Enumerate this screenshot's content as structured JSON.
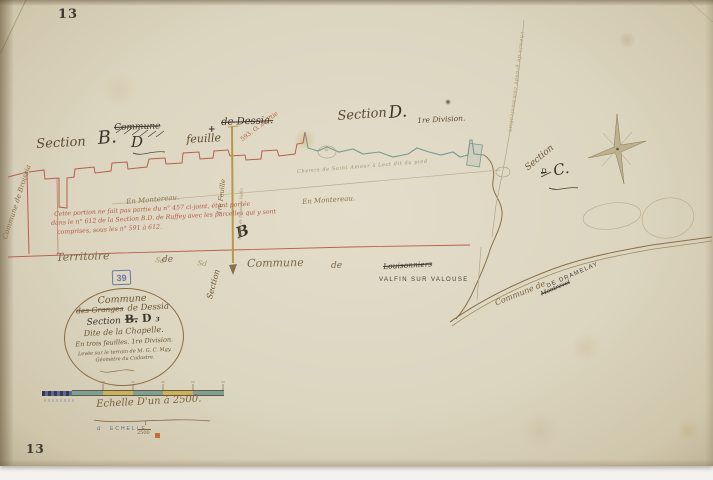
{
  "page": {
    "folio_top": "13",
    "folio_bottom": "13"
  },
  "colors": {
    "red_line": "#b5604e",
    "teal_line": "#7b9a92",
    "yellow_road": "#b9984a",
    "brown_ink": "#6b5535",
    "dark_ink": "#3c342a",
    "red_ink": "#ab5a48",
    "blue_stamp": "#5a68a0",
    "paper": "#dbd3bd"
  },
  "header": {
    "section_b": {
      "section": "Section",
      "letter": "B.",
      "d_word": "D",
      "feuille": "feuille",
      "struck_commune": "Commune",
      "cross": "+",
      "struck_dessia": "de Dessia.",
      "parcel_ref": "593. O. 2e Ptie"
    },
    "section_d": {
      "section": "Section",
      "letter": "D.",
      "division": "1re Division."
    }
  },
  "map": {
    "commune_left_vertical": "Commune de Broissia",
    "chemin_center": "Chemin de Saint Amour à Lect dit du pied",
    "lieu_dit_1": "En Montereau.",
    "lieu_dit_2": "En Montereau.",
    "note_line1": "Cette portion ne fait pas partie du n° 457 ci-joint, étant portée",
    "note_line2": "dans le n° 612 de la Section B.D. de Ruffey avec les parcelles qui y sont",
    "note_line3": "comprises, sous les n° 591 à 612.",
    "big_b": "B",
    "feuille_vertical": "1re Feuille",
    "road_micro_label": "chemin de Dessia à Valfin",
    "section_diagonal": "Section",
    "section_c": {
      "section": "Section",
      "struck": "D",
      "letter": "C."
    },
    "chemin_right_vertical": "chemin de grande communication",
    "blob_letter": "a",
    "sd_mark_1": "Sd",
    "sd_mark_2": "Sd"
  },
  "boundary_row": {
    "territoire": "Territoire",
    "de1": "de",
    "commune": "Commune",
    "de2": "de",
    "struck_name": "Louisonniers",
    "stamp": "VALFIN SUR VALOUSE",
    "dept_code": "39"
  },
  "dramelay": {
    "script": "Commune de",
    "struck": "Montrevel",
    "stamp": "DE DRAMELAY"
  },
  "cartouche": {
    "l1": "Commune",
    "struck": "des Granges",
    "l2": "de Dessia",
    "section_word": "Section",
    "code_b": "B.",
    "code_d": "D",
    "sup": "3",
    "l4": "Dite de la Chapelle.",
    "l5": "En trois feuilles. 1re Division.",
    "l6": "Levée sur le terrain de M. G. C. Mgy.",
    "l7": "Géomètre du Cadastre."
  },
  "scale": {
    "caption": "Echelle D'un à 2500.",
    "stamp_glyph": "a",
    "stamp": "ECHELLE",
    "frac_num": "1",
    "frac_den": "2500"
  }
}
